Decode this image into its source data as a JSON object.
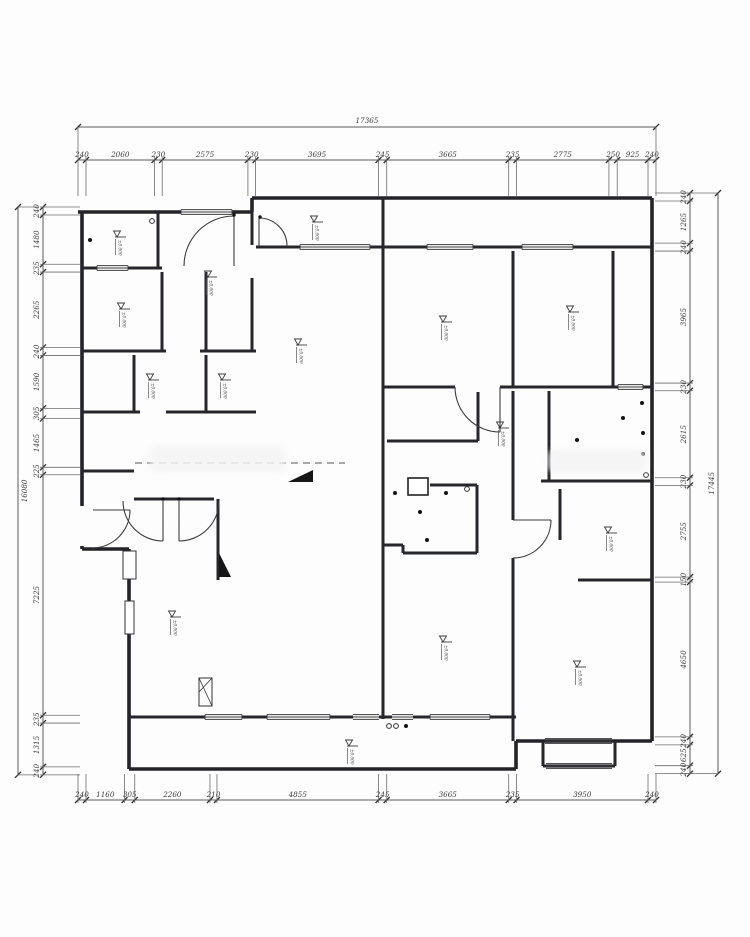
{
  "drawing": {
    "type": "floor-plan",
    "unit": "mm"
  },
  "dimensions": {
    "top": {
      "total": "17365",
      "segments": [
        240,
        2060,
        230,
        2575,
        230,
        3695,
        245,
        3665,
        235,
        2775,
        250,
        925,
        240
      ]
    },
    "bottom": {
      "segments": [
        240,
        1160,
        305,
        2260,
        210,
        4855,
        245,
        3665,
        235,
        3950,
        240
      ]
    },
    "left": {
      "total": "16080",
      "segments": [
        240,
        1480,
        235,
        2265,
        240,
        1590,
        305,
        1465,
        225,
        7225,
        235,
        1315,
        240
      ]
    },
    "right": {
      "total": "17445",
      "segments": [
        240,
        1265,
        240,
        3965,
        230,
        2615,
        230,
        2755,
        150,
        4650,
        240,
        625,
        240
      ]
    }
  },
  "markers": [
    {
      "x": 117,
      "y": 237,
      "label": "±0.000"
    },
    {
      "x": 208,
      "y": 277,
      "label": "±0.000"
    },
    {
      "x": 121,
      "y": 309,
      "label": "±0.000"
    },
    {
      "x": 150,
      "y": 380,
      "label": "±0.000"
    },
    {
      "x": 222,
      "y": 380,
      "label": "±0.000"
    },
    {
      "x": 298,
      "y": 345,
      "label": "±0.000"
    },
    {
      "x": 314,
      "y": 222,
      "label": "±0.000"
    },
    {
      "x": 443,
      "y": 322,
      "label": "±0.000"
    },
    {
      "x": 570,
      "y": 312,
      "label": "±0.000"
    },
    {
      "x": 500,
      "y": 428,
      "label": "±0.000"
    },
    {
      "x": 608,
      "y": 533,
      "label": "±0.000"
    },
    {
      "x": 577,
      "y": 667,
      "label": "±0.000"
    },
    {
      "x": 443,
      "y": 642,
      "label": "±0.000"
    },
    {
      "x": 172,
      "y": 617,
      "label": "±0.000"
    },
    {
      "x": 349,
      "y": 746,
      "label": "±0.000"
    }
  ],
  "lights": {
    "dots": [
      [
        395,
        493
      ],
      [
        446,
        493
      ],
      [
        420,
        512
      ],
      [
        427,
        540
      ],
      [
        642,
        403
      ],
      [
        623,
        418
      ],
      [
        643,
        433
      ],
      [
        577,
        440
      ],
      [
        643,
        454
      ],
      [
        406,
        726
      ],
      [
        90,
        240
      ]
    ],
    "circles": [
      [
        467,
        489
      ],
      [
        646,
        475
      ],
      [
        389,
        726
      ],
      [
        396,
        726
      ],
      [
        152,
        221
      ]
    ]
  }
}
